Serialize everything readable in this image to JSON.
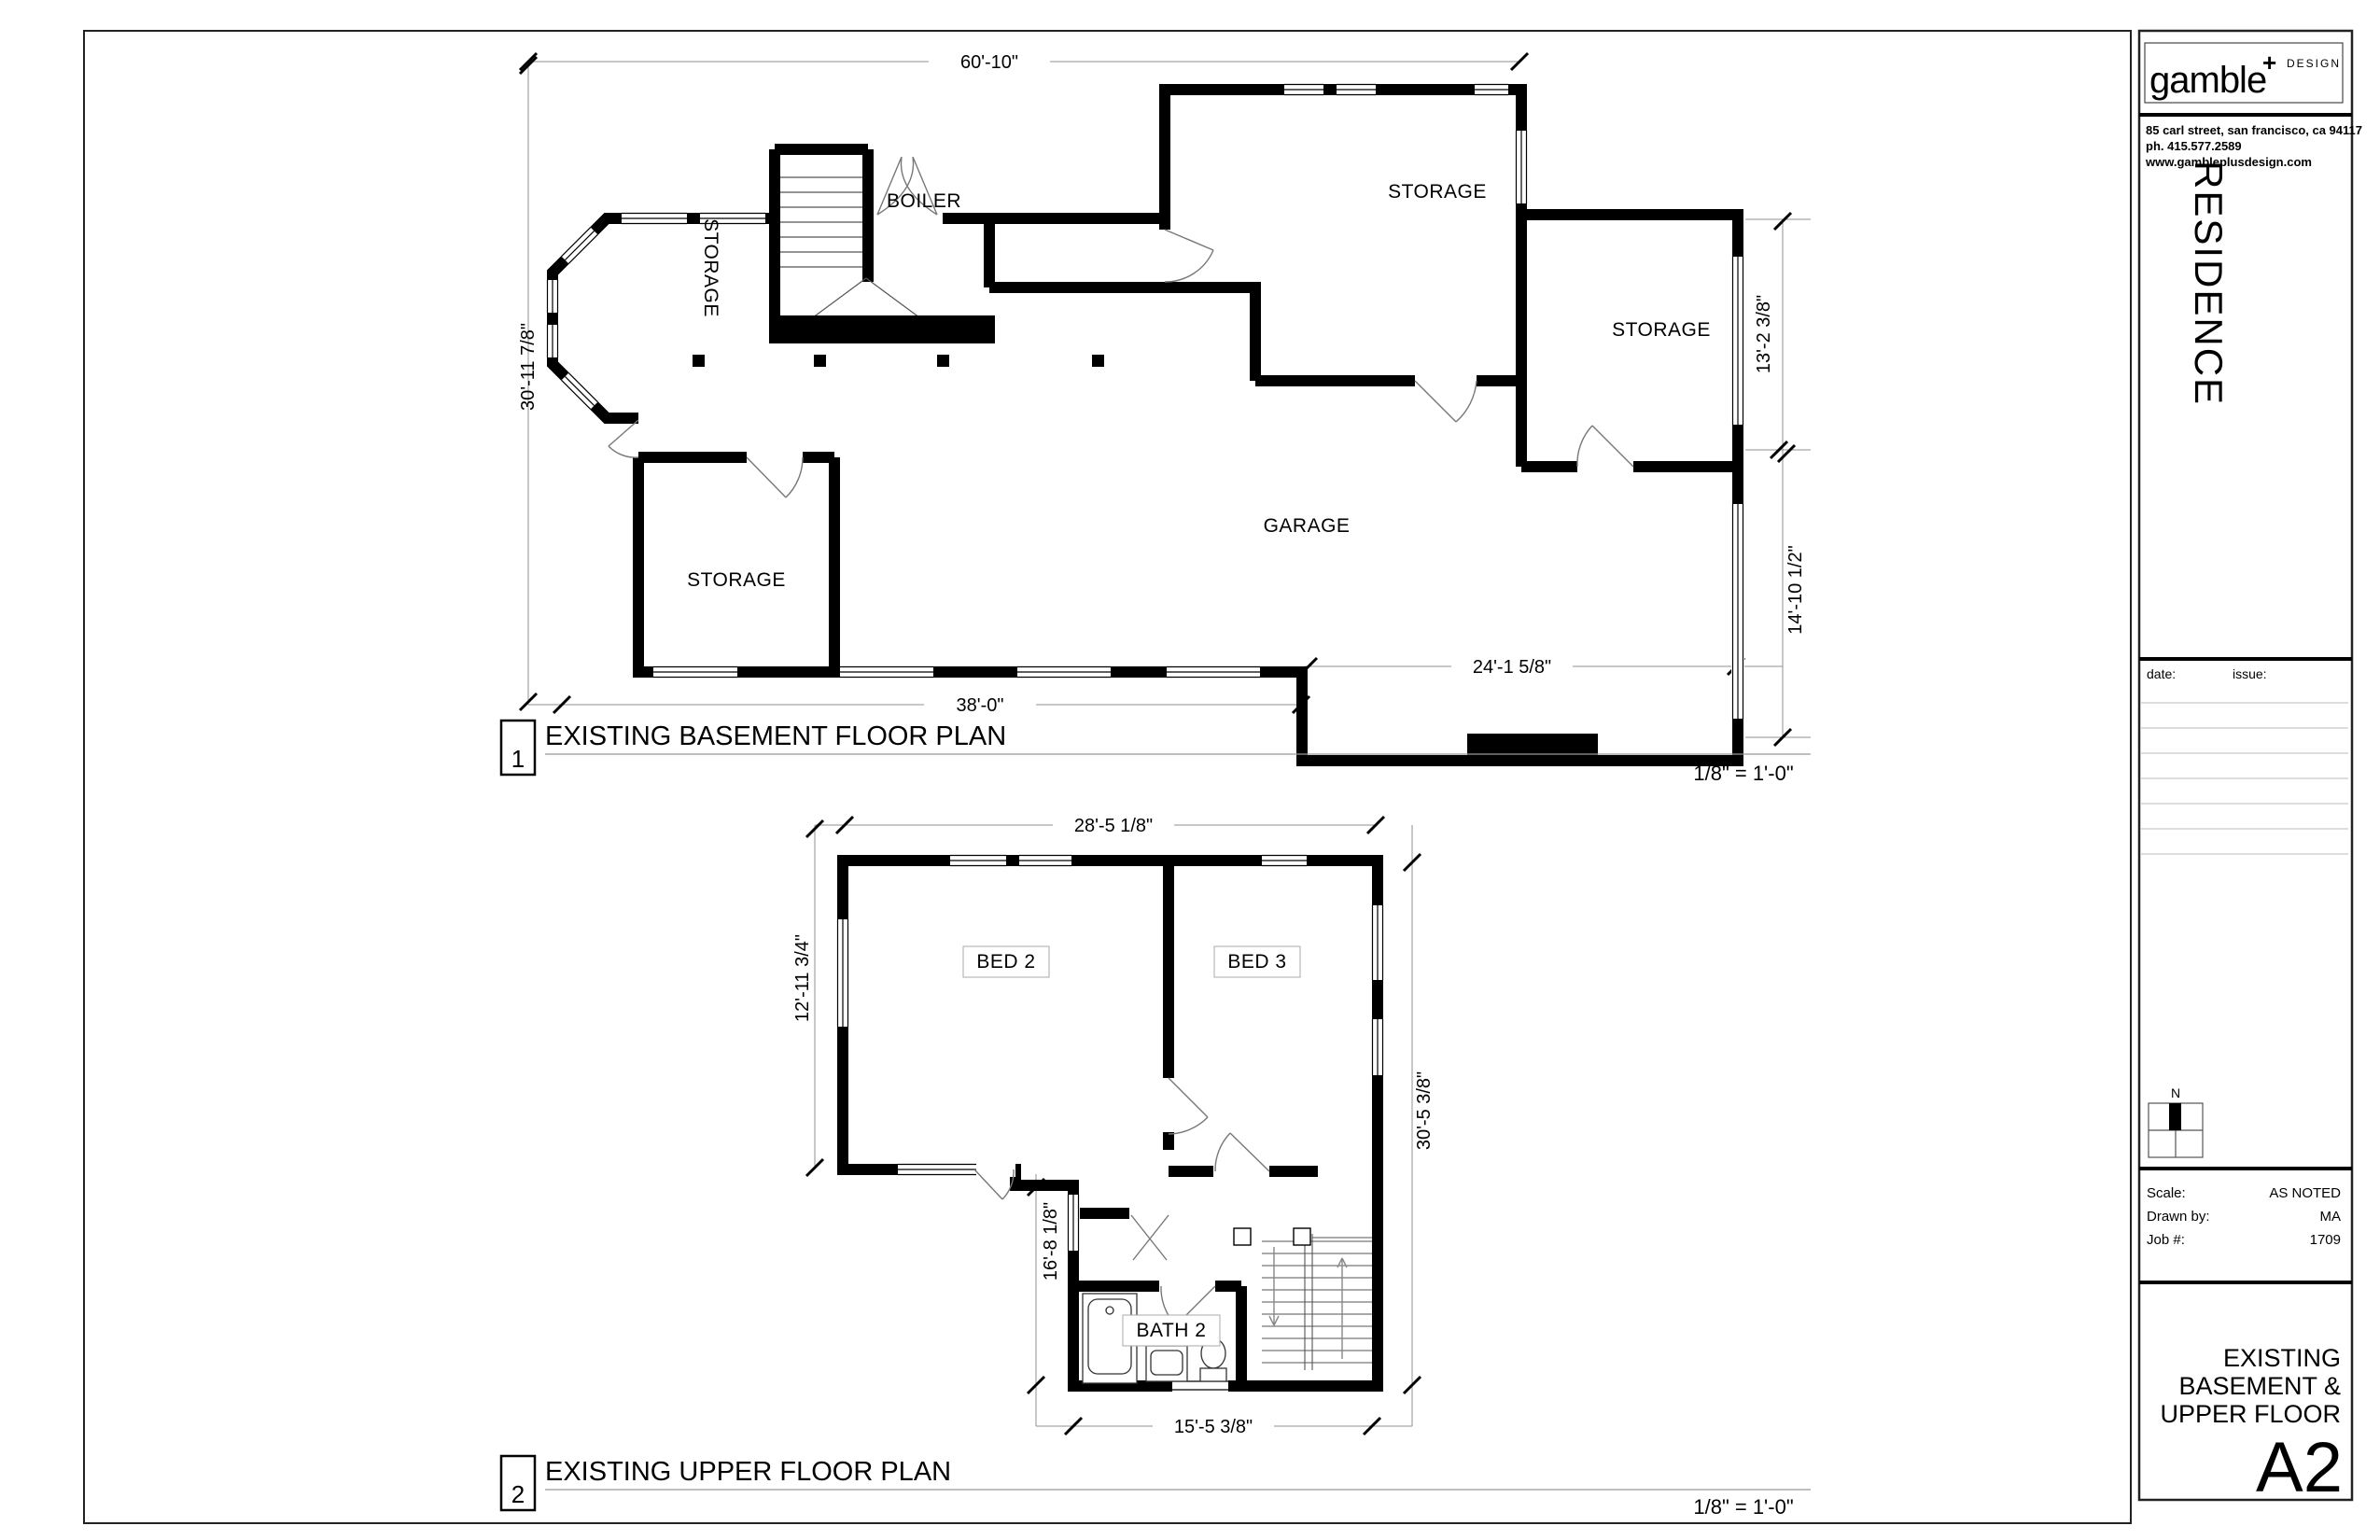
{
  "titleblock": {
    "logo_name": "gamble",
    "logo_plus": "+",
    "logo_suffix": "DESIGN",
    "address_line1": "85 carl street, san francisco, ca 94117",
    "address_line2": "ph.  415.577.2589",
    "address_line3": "www.gambleplusdesign.com",
    "project_name": "RESIDENCE",
    "date_label": "date:",
    "issue_label": "issue:",
    "north_label": "N",
    "scale_label": "Scale:",
    "scale_value": "AS NOTED",
    "drawn_by_label": "Drawn by:",
    "drawn_by_value": "MA",
    "job_label": "Job #:",
    "job_value": "1709",
    "sheet_title_line1": "EXISTING",
    "sheet_title_line2": "BASEMENT &",
    "sheet_title_line3": "UPPER FLOOR",
    "sheet_number": "A2"
  },
  "plan1": {
    "number": "1",
    "title": "EXISTING BASEMENT FLOOR PLAN",
    "scale": "1/8\" = 1'-0\"",
    "dim_top": "60'-10\"",
    "dim_left": "30'-11 7/8\"",
    "dim_right_upper": "13'-2 3/8\"",
    "dim_right_lower": "14'-10 1/2\"",
    "dim_bottom_inner": "24'-1 5/8\"",
    "dim_bottom": "38'-0\"",
    "room_storage_bay": "STORAGE",
    "room_boiler": "BOILER",
    "room_storage_main": "STORAGE",
    "room_storage_right": "STORAGE",
    "room_storage_lower": "STORAGE",
    "room_garage": "GARAGE"
  },
  "plan2": {
    "number": "2",
    "title": "EXISTING UPPER FLOOR PLAN",
    "scale": "1/8\" = 1'-0\"",
    "dim_top": "28'-5 1/8\"",
    "dim_left_upper": "12'-11 3/4\"",
    "dim_left_lower": "16'-8 1/8\"",
    "dim_right": "30'-5 3/8\"",
    "dim_bottom": "15'-5 3/8\"",
    "room_bed2": "BED 2",
    "room_bed3": "BED 3",
    "room_bath2": "BATH 2"
  }
}
